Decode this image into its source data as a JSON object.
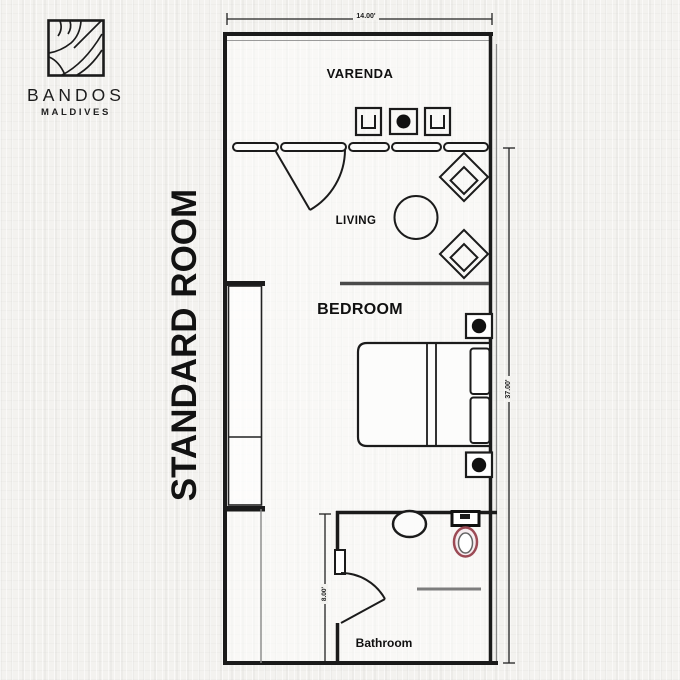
{
  "brand": {
    "name": "BANDOS",
    "location": "MALDIVES",
    "logo_icon": "bandos-sunrays-logo"
  },
  "plan": {
    "title": "STANDARD ROOM",
    "rooms": {
      "veranda": "VARENDA",
      "living": "LIVING",
      "bedroom": "BEDROOM",
      "bathroom": "Bathroom"
    },
    "dimensions": {
      "overall_width": "14.00'",
      "overall_depth": "37.00'",
      "bathroom_depth": "8.00'"
    },
    "furniture_icons": [
      "veranda-chair-icon",
      "veranda-table-icon",
      "entry-door-icon",
      "coffee-table-icon",
      "lounge-chair-icon",
      "wardrobe-icon",
      "double-bed-icon",
      "pillow-icon",
      "nightstand-lamp-icon",
      "sink-icon",
      "toilet-icon",
      "bathroom-door-icon",
      "window-pane-icon"
    ],
    "colors": {
      "line": "#1b1b1b",
      "background": "#f3f2ef",
      "partition_gray": "#7d7d7d",
      "toilet_accent": "#9c4a55"
    }
  }
}
